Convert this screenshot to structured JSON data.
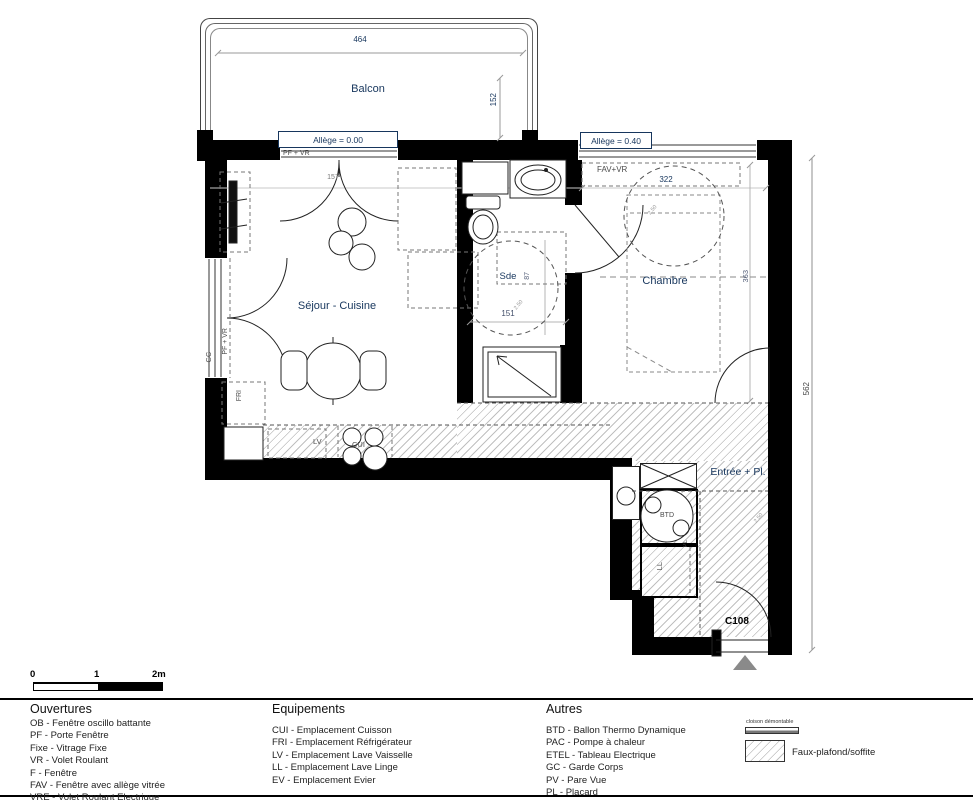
{
  "plan": {
    "rooms": {
      "balcony": "Balcon",
      "living_kitchen": "Séjour - Cuisine",
      "bathroom": "Sde",
      "bedroom": "Chambre",
      "entrance": "Entrée + Pl."
    },
    "dims": {
      "balcony_width": "464",
      "balcony_depth": "152",
      "bedroom_width": "322",
      "bedroom_depth": "363",
      "overall_height": "562",
      "bathroom_width": "151",
      "bathroom_depth": "87",
      "window_width": "157"
    },
    "annotations": {
      "allege_0": "Allège = 0.00",
      "allege_40": "Allège = 0.40",
      "pf_vr": "PF + VR",
      "fav_vr": "FAV+VR",
      "gc": "GC",
      "fri": "FRI",
      "lv": "LV",
      "cui": "CUI",
      "btd": "BTD",
      "ll": "LL",
      "pl": "PL",
      "unit_number": "C108",
      "ceiling_note": "2.50"
    }
  },
  "scalebar": {
    "t0": "0",
    "t1": "1",
    "t2": "2m"
  },
  "legend": {
    "ouvertures": {
      "title": "Ouvertures",
      "items": [
        "OB - Fenêtre oscillo battante",
        "PF - Porte Fenêtre",
        "Fixe - Vitrage Fixe",
        "VR - Volet Roulant",
        "F - Fenêtre",
        "FAV - Fenêtre avec allège vitrée",
        "VRE - Volet Roulant Electrique"
      ]
    },
    "equipements": {
      "title": "Equipements",
      "items": [
        "CUI - Emplacement Cuisson",
        "FRI - Emplacement Réfrigérateur",
        "LV - Emplacement Lave Vaisselle",
        "LL - Emplacement Lave Linge",
        "EV - Emplacement Evier"
      ]
    },
    "autres": {
      "title": "Autres",
      "items": [
        "BTD - Ballon Thermo Dynamique",
        "PAC - Pompe à chaleur",
        "ETEL - Tableau Electrique",
        "GC - Garde Corps",
        "PV - Pare Vue",
        "PL - Placard"
      ]
    },
    "symbols": {
      "cloison": "cloison démontable",
      "faux_plafond": "Faux-plafond/soffite"
    }
  },
  "colors": {
    "wall": "#000000",
    "label_blue": "#17365d",
    "hatch_line": "#c0c0c0",
    "dim_line": "#999999"
  }
}
